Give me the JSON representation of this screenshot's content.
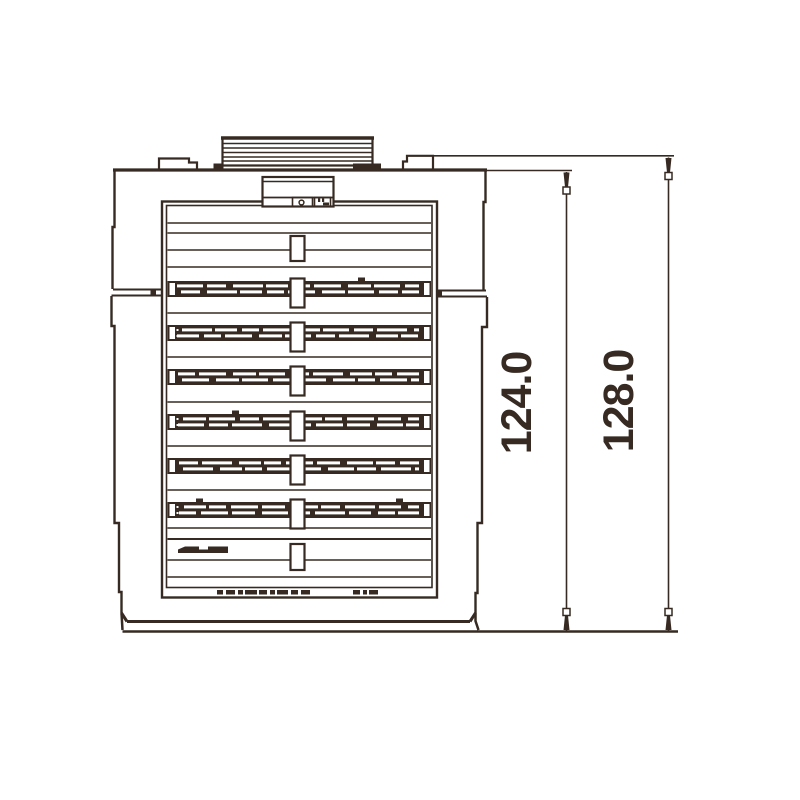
{
  "drawing": {
    "type": "technical-front-view",
    "background_color": "#ffffff",
    "ink_color": "#362a22",
    "louver_row_count": 6,
    "dimensions": [
      {
        "label": "124.0",
        "axis": "vertical"
      },
      {
        "label": "128.0",
        "axis": "vertical"
      }
    ]
  }
}
